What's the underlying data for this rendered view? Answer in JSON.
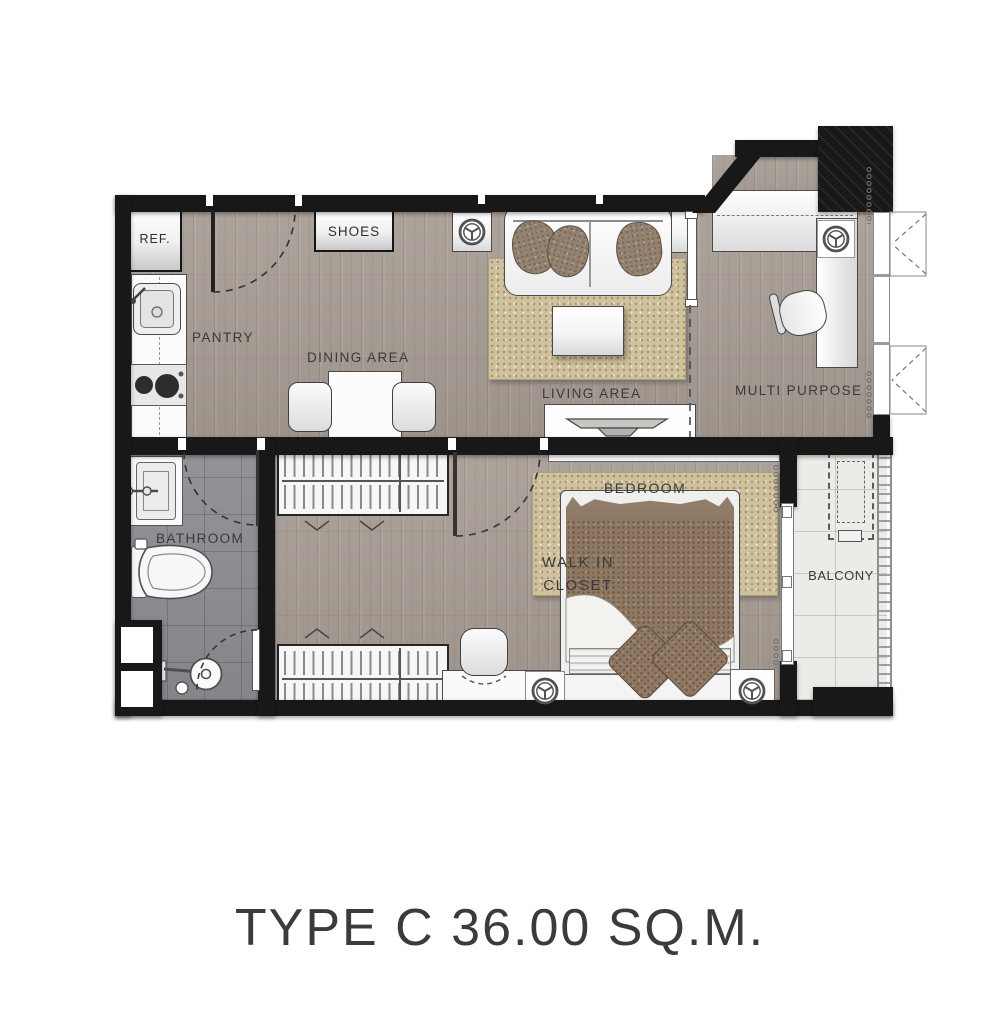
{
  "title": "TYPE C 36.00 SQ.M.",
  "labels": {
    "ref": "REF.",
    "pantry": "PANTRY",
    "shoes": "SHOES",
    "dining": "DINING AREA",
    "living": "LIVING AREA",
    "multi_purpose": "MULTI PURPOSE",
    "bathroom": "BATHROOM",
    "walk_in_closet_line1": "WALK IN",
    "walk_in_closet_line2": "CLOSET",
    "bedroom": "BEDROOM",
    "balcony": "BALCONY"
  },
  "icons": {
    "sprinkler": "sprinkler-head-circle-with-three-spokes",
    "casement_window": "dashed-triangle-window-swing",
    "door_swing": "dashed-quarter-arc",
    "curtain": "coil-chain"
  },
  "colors": {
    "wall": "#181818",
    "wood_floor": "#a69c94",
    "bath_tile": "#8d8d92",
    "balcony_tile": "#ebebe8",
    "rug": "#cec19c",
    "bed_duvet": "#8e7862",
    "label_text": "#3a3a3a"
  }
}
